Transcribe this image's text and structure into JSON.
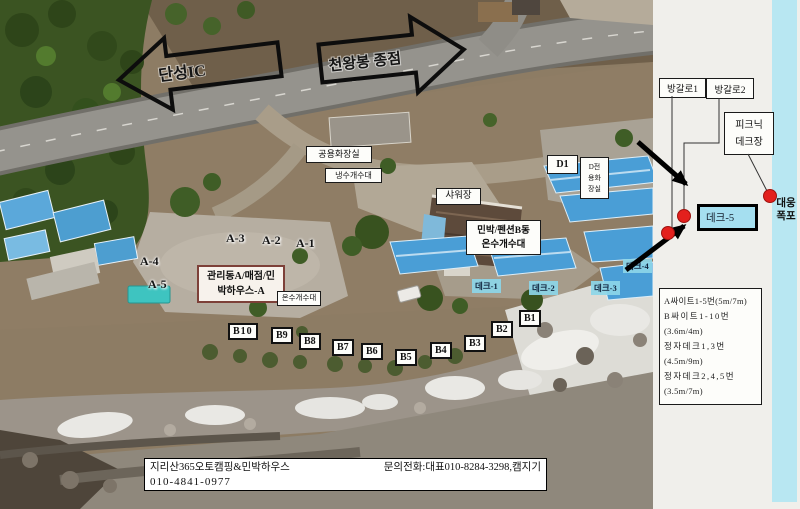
{
  "arrows": {
    "left_label": "단성IC",
    "right_label": "천왕봉 종점"
  },
  "map": {
    "public_restroom": "공용화장실",
    "cold_sink": "냉수개수대",
    "shower": "샤워장",
    "pension_b": {
      "l1": "민박/펜션B동",
      "l2": "온수개수대"
    },
    "office": {
      "l1": "관리동A/매점/민",
      "l2": "박하우스-A"
    },
    "hot_sink": "온수개수대",
    "d1": "D1",
    "d_restroom": {
      "l1": "D전",
      "l2": "용화",
      "l3": "장실"
    },
    "a_sites": [
      "A-1",
      "A-2",
      "A-3",
      "A-4",
      "A-5"
    ],
    "b_sites": [
      "B1",
      "B2",
      "B3",
      "B4",
      "B5",
      "B6",
      "B7",
      "B8",
      "B9",
      "B10"
    ],
    "decks": [
      "데크-1",
      "데크-2",
      "데크-3",
      "데크-4"
    ]
  },
  "panel": {
    "bungalow1": "방갈로1",
    "bungalow2": "방갈로2",
    "picnic": {
      "l1": "피크닉",
      "l2": "데크장"
    },
    "deck5": "데크-5",
    "waterfall": {
      "l1": "대웅",
      "l2": "폭포"
    },
    "legend": [
      "A싸이트1-5번(5m/7m)",
      "B싸이트1-10번",
      "(3.6m/4m)",
      "정자데크1,3번",
      "(4.5m/9m)",
      "정자데크2,4,5번",
      "(3.5m/7m)"
    ]
  },
  "footer": {
    "site_name": "지리산365오토캠핑&민박하우스",
    "contact": "문의전화:대표010-8284-3298,캠지기",
    "phone": "010-4841-0977"
  },
  "colors": {
    "marker_red": "#e3201d",
    "deck_cyan": "#a5dff0",
    "strip_blue": "#b8e7f2"
  }
}
